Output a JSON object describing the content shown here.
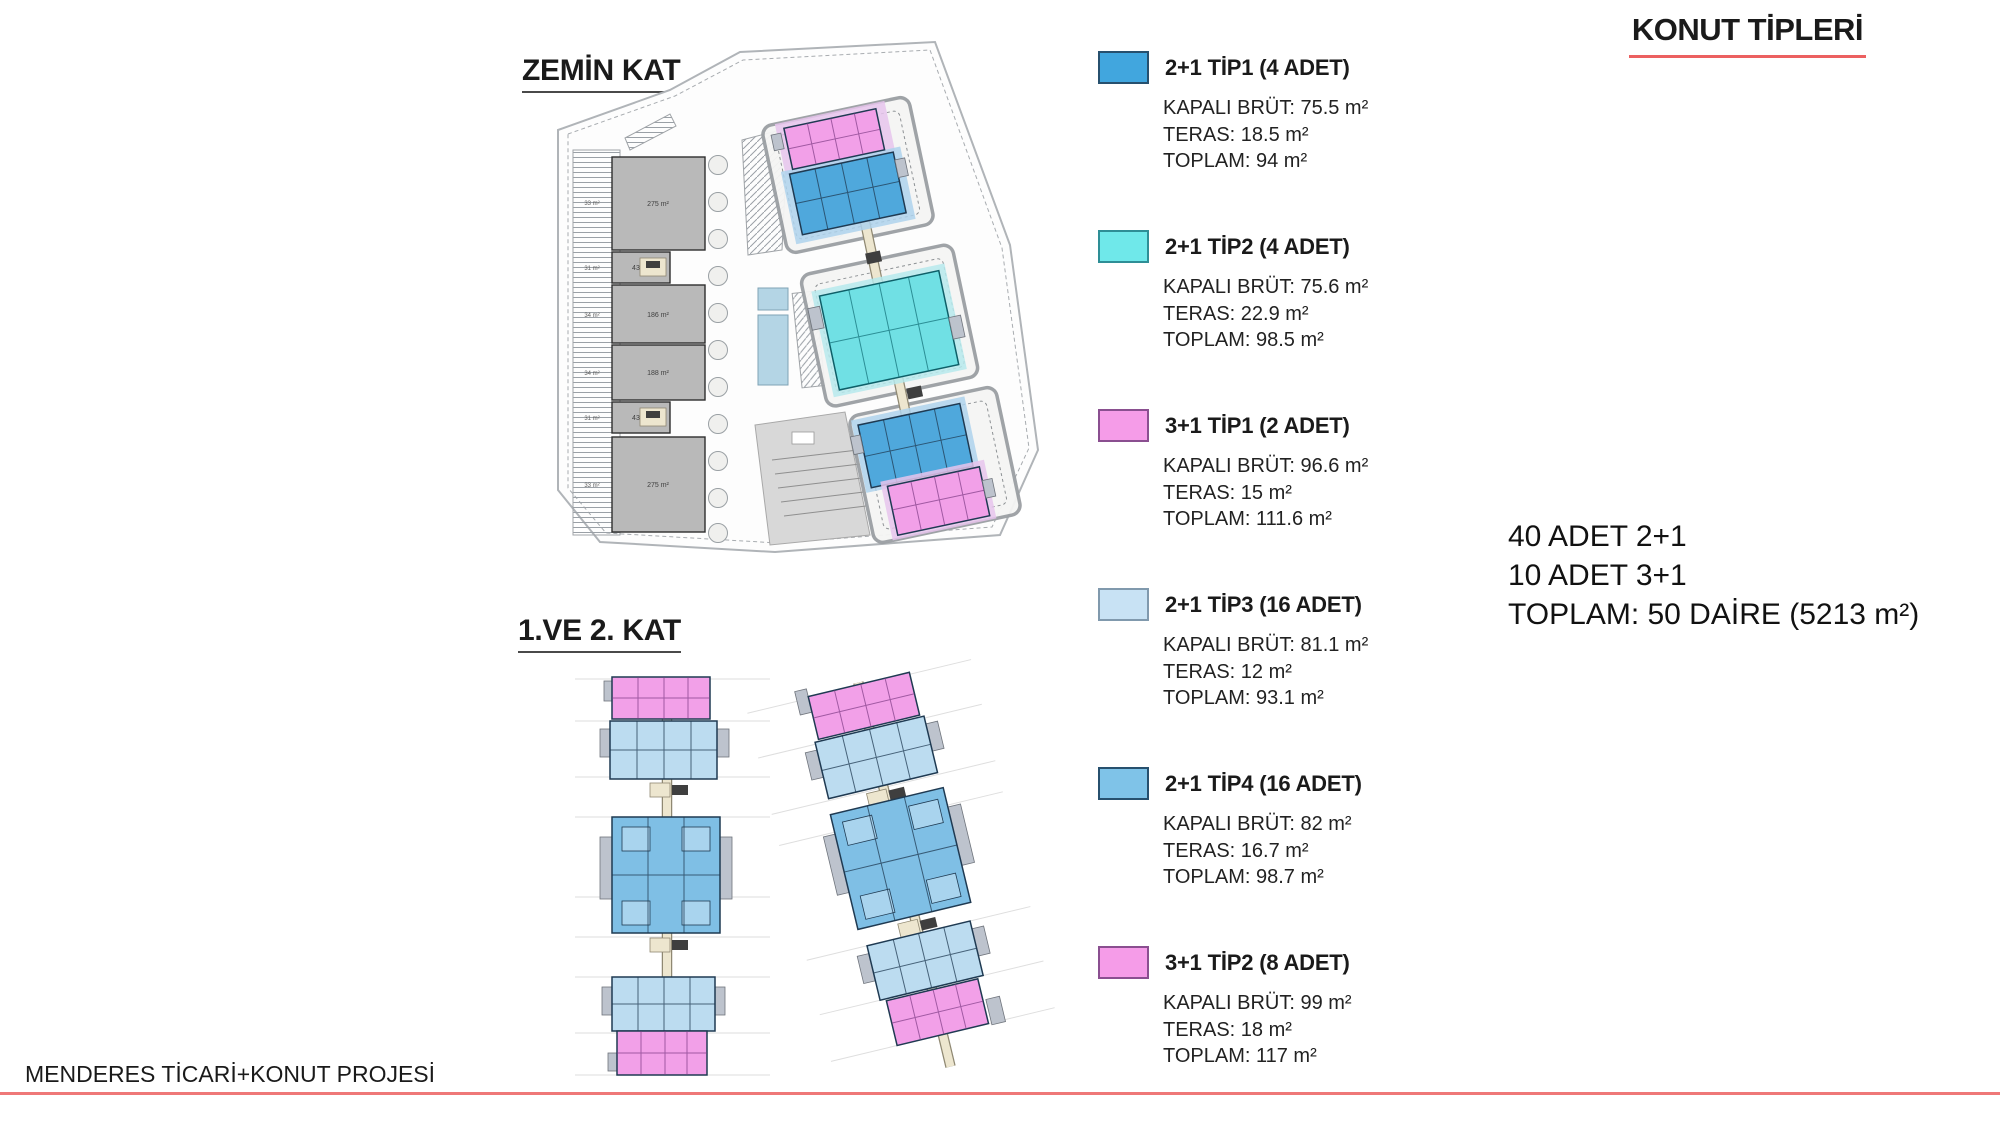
{
  "title": "KONUT TİPLERİ",
  "plans": {
    "ground": {
      "label": "ZEMİN KAT",
      "shop_areas": [
        "275 m²",
        "43 m²",
        "186 m²",
        "188 m²",
        "43 m²",
        "275 m²"
      ],
      "strip_areas": [
        "33 m²",
        "31 m²",
        "34 m²",
        "34 m²",
        "31 m²",
        "33 m²"
      ]
    },
    "upper": {
      "label": "1.VE 2. KAT"
    }
  },
  "legend": {
    "items": [
      {
        "title": "2+1 TİP1 (4 ADET)",
        "color": "#41a6de",
        "border": "#27506e",
        "kapali_brut": "KAPALI BRÜT: 75.5 m²",
        "teras": "TERAS: 18.5 m²",
        "toplam": "TOPLAM: 94 m²"
      },
      {
        "title": "2+1 TİP2 (4 ADET)",
        "color": "#6fe8ea",
        "border": "#2e8e96",
        "kapali_brut": "KAPALI BRÜT: 75.6 m²",
        "teras": "TERAS: 22.9 m²",
        "toplam": "TOPLAM: 98.5 m²"
      },
      {
        "title": "3+1 TİP1 (2 ADET)",
        "color": "#f59ce8",
        "border": "#8a4f90",
        "kapali_brut": "KAPALI BRÜT: 96.6 m²",
        "teras": "TERAS: 15 m²",
        "toplam": "TOPLAM: 111.6 m²"
      },
      {
        "title": "2+1 TİP3 (16 ADET)",
        "color": "#c8e2f4",
        "border": "#8099ad",
        "kapali_brut": "KAPALI BRÜT: 81.1 m²",
        "teras": "TERAS: 12 m²",
        "toplam": "TOPLAM: 93.1 m²"
      },
      {
        "title": "2+1 TİP4 (16 ADET)",
        "color": "#7fc3e8",
        "border": "#27506e",
        "kapali_brut": "KAPALI BRÜT: 82 m²",
        "teras": "TERAS: 16.7 m²",
        "toplam": "TOPLAM: 98.7 m²"
      },
      {
        "title": "3+1 TİP2 (8 ADET)",
        "color": "#f59ce8",
        "border": "#8a4f90",
        "kapali_brut": "KAPALI BRÜT: 99 m²",
        "teras": "TERAS: 18 m²",
        "toplam": "TOPLAM: 117 m²"
      }
    ]
  },
  "summary": {
    "line1": "40 ADET 2+1",
    "line2": "10 ADET 3+1",
    "line3": "TOPLAM: 50 DAİRE (5213 m²)"
  },
  "footer": {
    "project": "MENDERES TİCARİ+KONUT PROJESİ"
  },
  "colors": {
    "accentRed": "#ec6060",
    "underlineDark": "#4a4a4a",
    "pink": "#f2a0e8",
    "pinkPale": "#e6c4ec",
    "blue": "#4fa8dc",
    "blueMid": "#7fbfe5",
    "blueLight": "#bcdcf0",
    "bluePale": "#aed2ec",
    "cyan": "#70e0e4",
    "cyanPale": "#b6e9ec",
    "grayShop": "#b9b9b9",
    "grayTab": "#bdc3cd",
    "beige": "#ede6cf",
    "wallStroke": "#1f3a52",
    "pool": "#b4d5e5",
    "padFill": "#f5f5f4"
  }
}
